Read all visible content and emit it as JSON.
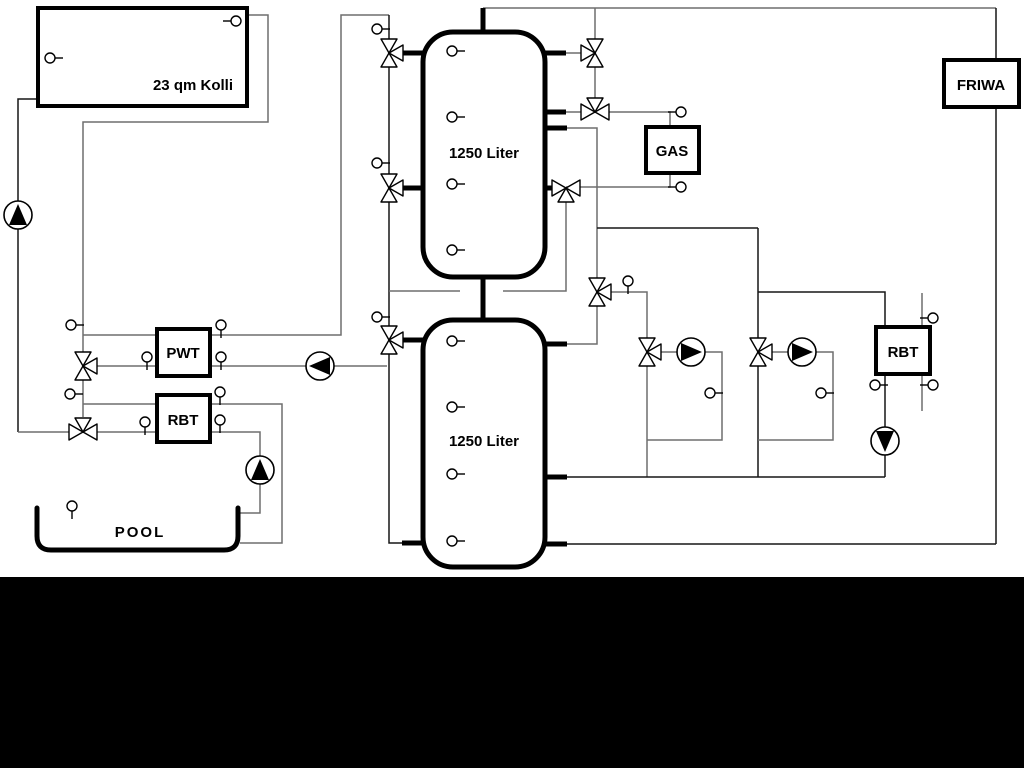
{
  "diagram": {
    "labels": {
      "collector": "23 qm Kolli",
      "tank_top": "1250 Liter",
      "tank_bottom": "1250 Liter",
      "pwt": "PWT",
      "rbt_left": "RBT",
      "rbt_right": "RBT",
      "gas": "GAS",
      "friwa": "FRIWA",
      "pool": "POOL"
    },
    "colors": {
      "background": "#ffffff",
      "pipe_gray": "#6e6e6e",
      "pipe_dark": "#161616",
      "outline": "#000000",
      "band": "#000000",
      "symbol_fill": "#ffffff"
    },
    "icon_legend": {
      "three_way_valve_icon": "three triangles meeting at a point",
      "pump_icon": "circle with solid triangle showing flow direction",
      "sensor_icon": "small circle with stub line (temperature sensor)"
    }
  }
}
